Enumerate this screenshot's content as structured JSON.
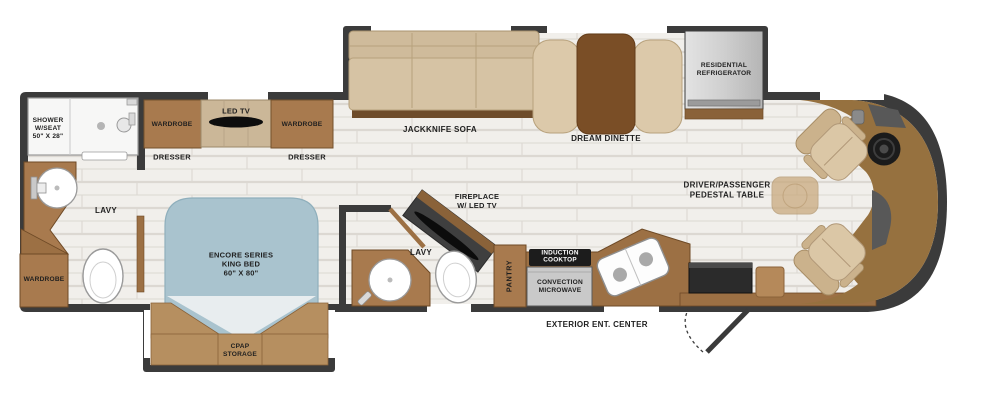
{
  "colors": {
    "wall": "#3b3b3b",
    "floor": "#f1efeb",
    "floor_line": "#dcd8d2",
    "cabinet": "#a87a4e",
    "counter": "#9c7044",
    "wood_table": "#7a4e26",
    "upholstery": "#d6c3a4",
    "bed": "#a9c3ce",
    "dashboard": "#96713f",
    "appliance_gray": "#c9c9c9",
    "cooktop_black": "#1c1c1c",
    "label_text": "#1f1f1f",
    "window_white": "#ffffff"
  },
  "bath_rear": {
    "shower": "SHOWER\nW/SEAT\n50\" X 28\"",
    "lavy": "LAVY",
    "wardrobe": "WARDROBE"
  },
  "bedroom": {
    "wardrobe_left": "WARDROBE",
    "led_tv": "LED TV",
    "wardrobe_right": "WARDROBE",
    "dresser_left": "DRESSER",
    "dresser_right": "DRESSER",
    "bed": "ENCORE SERIES\nKING BED\n60\" X 80\"",
    "cpap": "CPAP\nSTORAGE"
  },
  "bath_mid": {
    "lavy": "LAVY",
    "fireplace": "FIREPLACE\nW/ LED TV"
  },
  "kitchen": {
    "pantry": "PANTRY",
    "induction": "INDUCTION\nCOOKTOP",
    "microwave": "CONVECTION\nMICROWAVE"
  },
  "living": {
    "sofa": "JACKKNIFE SOFA",
    "dinette": "DREAM DINETTE",
    "refrigerator": "RESIDENTIAL\nREFRIGERATOR"
  },
  "front": {
    "pedestal_table": "DRIVER/PASSENGER\nPEDESTAL TABLE"
  },
  "exterior": {
    "ent_center": "EXTERIOR ENT. CENTER"
  }
}
